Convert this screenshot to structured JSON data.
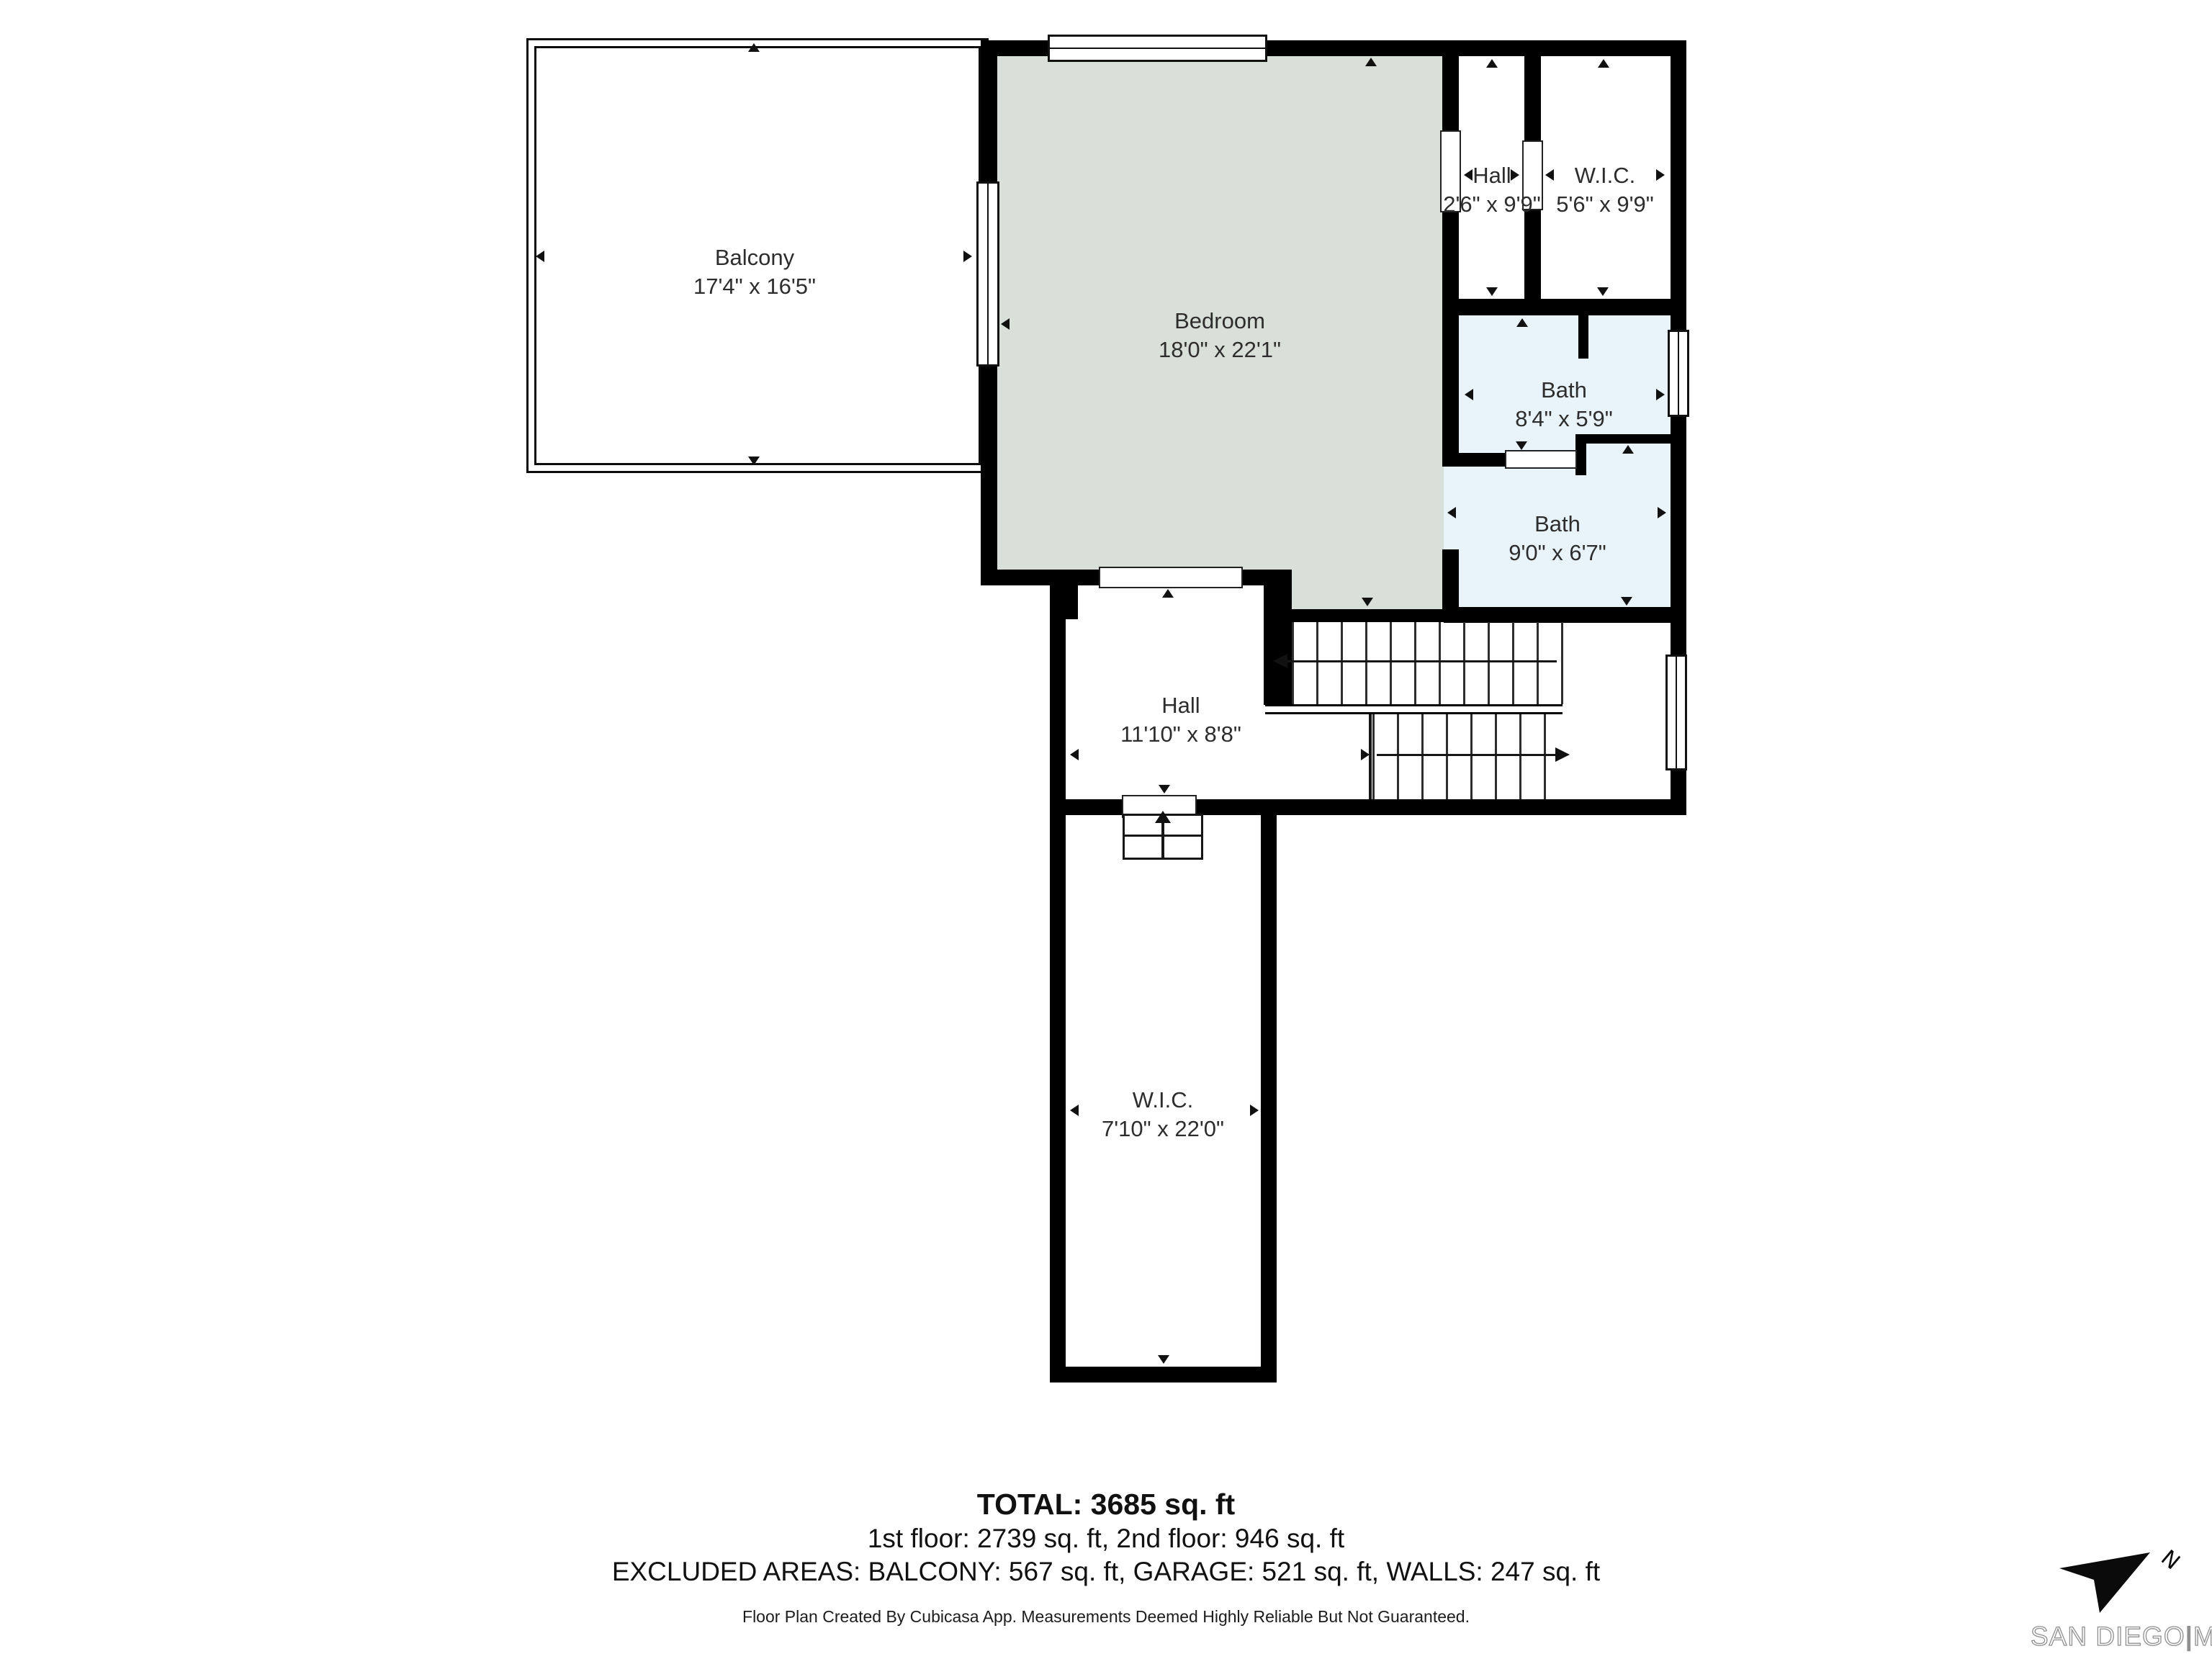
{
  "rooms": [
    {
      "id": "balcony",
      "name": "Balcony",
      "dims": "17'4\" x 16'5\""
    },
    {
      "id": "bedroom",
      "name": "Bedroom",
      "dims": "18'0\" x 22'1\""
    },
    {
      "id": "hall-upper",
      "name": "Hall",
      "dims": "2'6\" x 9'9\""
    },
    {
      "id": "wic-upper",
      "name": "W.I.C.",
      "dims": "5'6\" x 9'9\""
    },
    {
      "id": "bath-1",
      "name": "Bath",
      "dims": "8'4\" x 5'9\""
    },
    {
      "id": "bath-2",
      "name": "Bath",
      "dims": "9'0\" x 6'7\""
    },
    {
      "id": "hall-main",
      "name": "Hall",
      "dims": "11'10\" x 8'8\""
    },
    {
      "id": "wic-main",
      "name": "W.I.C.",
      "dims": "7'10\" x 22'0\""
    }
  ],
  "summary": {
    "total": "TOTAL: 3685 sq. ft",
    "floors": "1st floor: 2739 sq. ft, 2nd floor: 946 sq. ft",
    "excluded": "EXCLUDED AREAS: BALCONY: 567 sq. ft, GARAGE: 521 sq. ft, WALLS: 247 sq. ft",
    "disclaimer": "Floor Plan Created By Cubicasa App. Measurements Deemed Highly Reliable But Not Guaranteed."
  },
  "logo": {
    "brand": "SAN DIEGO",
    "divider": "|",
    "suffix": "MLS",
    "compass_letter": "N"
  },
  "colors": {
    "bedroom_fill": "#d9e0da",
    "bath_fill": "#e9f3fa",
    "wall": "#000000"
  }
}
